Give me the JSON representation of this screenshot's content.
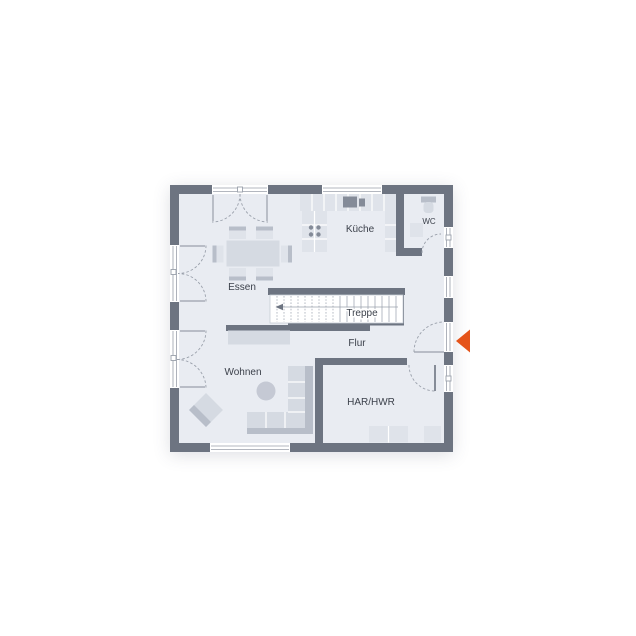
{
  "rooms": {
    "kueche": "Küche",
    "wc": "WC",
    "essen": "Essen",
    "treppe": "Treppe",
    "flur": "Flur",
    "wohnen": "Wohnen",
    "har_hwr": "HAR/HWR"
  },
  "icons": {
    "entrance_marker": "entrance-arrow"
  },
  "colors": {
    "background": "#ffffff",
    "wall": "#6d7481",
    "floor": "#e9ecf2",
    "counter": "#dfe3ea",
    "appliance": "#848b98",
    "furniture": "#dfe3ea",
    "furniture_mid": "#d5dae2",
    "furniture_dark": "#b8bec9",
    "line": "#9aa0ab",
    "stair_line": "#a5abb6",
    "stair_edge": "#c6ccd5",
    "text": "#3c414b",
    "accent": "#e5541a"
  }
}
